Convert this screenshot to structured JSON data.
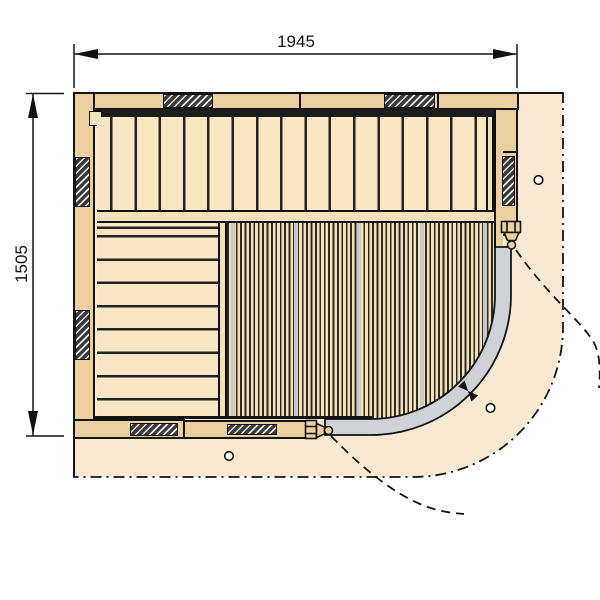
{
  "drawing": {
    "title": "sauna-floor-plan",
    "dimensions": {
      "width_label": "1945",
      "height_label": "1505"
    },
    "structure": {
      "upper_bench_slats": 17,
      "left_bench_slats": 9,
      "wall_stud_hatches": 7,
      "mounting_holes": 3,
      "door_type": "curved-glass-corner-door"
    },
    "colors": {
      "wall_wood": "#eccfa1",
      "bench_wood": "#f7e7c3",
      "trim_wood": "#f2e2bc",
      "floor_apron": "#f9e9d2",
      "glass_door_gray": "#ced1d5",
      "line_black": "#141414",
      "stripe_dark": "#2e2a26",
      "silver_stripe": "#c8cace"
    }
  }
}
